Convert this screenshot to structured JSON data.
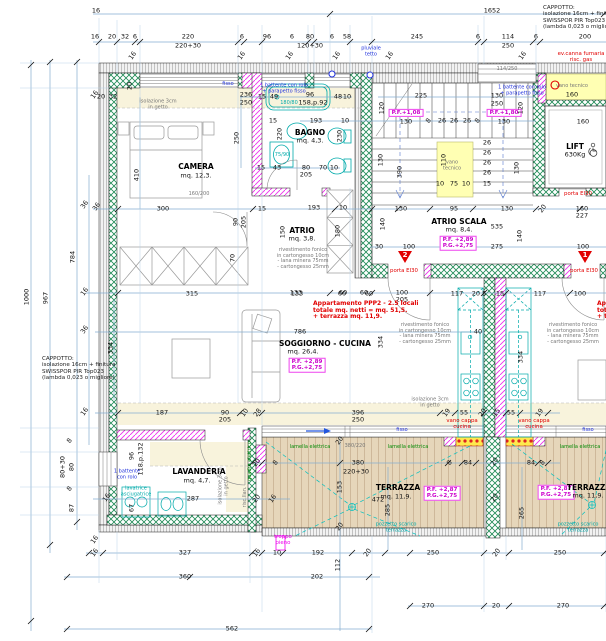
{
  "drawing": {
    "kind": "apartment floor plan",
    "apartment_note": "Appartamento PPP2 - 2.5 locali\ntotale mq. netti = mq. 51,5.\n+ terrazza mq. 11,9.",
    "cappotto_note": "CAPPOTTO:\nisolazione 16cm + finitura\nSWISSPOR PIR Top023\n(lambda 0,023 o migliore)",
    "rooms": [
      {
        "name": "CAMERA",
        "area": "mq. 12,3."
      },
      {
        "name": "BAGNO",
        "area": "mq. 4,3."
      },
      {
        "name": "ATRIO",
        "area": "mq. 3,8."
      },
      {
        "name": "ATRIO SCALA",
        "area": "mq. 8,4."
      },
      {
        "name": "SOGGIORNO - CUCINA",
        "area": "mq. 26,4."
      },
      {
        "name": "LAVANDERIA",
        "area": "mq. 4,7."
      },
      {
        "name": "TERRAZZA",
        "area": "mq. 11,9."
      },
      {
        "name": "LIFT",
        "load": "630Kg"
      }
    ],
    "levels": [
      "P.F.+1,08",
      "P.F.+1,80",
      "P.F. +2,89 / P.G.+2,75",
      "P.F. +2,87 / P.G.+2,75"
    ],
    "colors": {
      "structural_wall": "#1e8a55",
      "partition": "#ee30ee",
      "insulation_hatch": "#909090",
      "dim_line": "#85aed1",
      "fixture": "#00aaaa",
      "fire_label": "#e10000",
      "terrace_floor": "#e6d6ba",
      "vano_tecnico": "#ffffb3",
      "screed_band": "#f8f3dc"
    }
  },
  "labels": [
    [
      "1652",
      492,
      11,
      "d"
    ],
    [
      "16",
      96,
      11,
      "d"
    ],
    [
      "16",
      95,
      37,
      "d"
    ],
    [
      "20",
      112,
      37,
      "d"
    ],
    [
      "32",
      125,
      37,
      "d"
    ],
    [
      "6",
      135,
      37,
      "d"
    ],
    [
      "220",
      188,
      37,
      "d"
    ],
    [
      "6",
      242,
      37,
      "d"
    ],
    [
      "96",
      267,
      37,
      "d"
    ],
    [
      "6",
      292,
      37,
      "d"
    ],
    [
      "80",
      310,
      37,
      "d"
    ],
    [
      "6",
      332,
      37,
      "d"
    ],
    [
      "58",
      347,
      37,
      "d"
    ],
    [
      "245",
      417,
      37,
      "d"
    ],
    [
      "6",
      478,
      37,
      "d"
    ],
    [
      "114",
      508,
      37,
      "d"
    ],
    [
      "6",
      536,
      37,
      "d"
    ],
    [
      "200",
      585,
      37,
      "d"
    ],
    [
      "220+30",
      188,
      46,
      "d"
    ],
    [
      "120+30",
      310,
      46,
      "d"
    ],
    [
      "250",
      508,
      46,
      "d"
    ],
    [
      "pluviale\ntetto",
      371,
      52,
      "b"
    ],
    [
      "CAPPOTTO:\nisolazione 16cm + finitura\nSWISSPOR PIR Top023\n(lambda 0,023 o migliore)",
      543,
      5,
      "nl"
    ],
    [
      "ev.canna fumaria\nrisc. gas",
      581,
      57,
      "r"
    ],
    [
      "16",
      133,
      56,
      "d",
      -55
    ],
    [
      "16",
      242,
      56,
      "d",
      -55
    ],
    [
      "16",
      290,
      56,
      "d",
      -55
    ],
    [
      "16",
      337,
      56,
      "d",
      -55
    ],
    [
      "16",
      390,
      56,
      "d",
      -55
    ],
    [
      "16",
      523,
      56,
      "d",
      -55
    ],
    [
      "114/250",
      507,
      70,
      "s"
    ],
    [
      "1000",
      27,
      297,
      "d",
      -90
    ],
    [
      "967",
      46,
      298,
      "d",
      -90
    ],
    [
      "784",
      73,
      257,
      "d",
      -90
    ],
    [
      "36",
      85,
      205,
      "d",
      -55
    ],
    [
      "16",
      85,
      292,
      "d",
      -55
    ],
    [
      "36",
      85,
      330,
      "d",
      -55
    ],
    [
      "16",
      85,
      412,
      "d",
      -55
    ],
    [
      "CAPPOTTO:\nisolazione 16cm + finitura\nSWISSPOR PIR Top023\n(lambda 0,023 o migliore)",
      42,
      356,
      "nl"
    ],
    [
      "8",
      70,
      441,
      "d",
      -55
    ],
    [
      "80+30",
      63,
      467,
      "d",
      -90
    ],
    [
      "80",
      72,
      467,
      "d",
      -90
    ],
    [
      "8",
      70,
      489,
      "d",
      -55
    ],
    [
      "87",
      72,
      508,
      "d",
      -90
    ],
    [
      "16",
      95,
      95,
      "d",
      -55
    ],
    [
      "16",
      95,
      540,
      "d",
      -55
    ],
    [
      "fisso",
      228,
      85,
      "b"
    ],
    [
      "236",
      246,
      95,
      "d"
    ],
    [
      "250",
      246,
      103,
      "d"
    ],
    [
      "1 battente con rolo\n+ parapetto fisso",
      284,
      89,
      "b"
    ],
    [
      "isolazione 3cm\nin getto",
      158,
      105,
      "s"
    ],
    [
      "20",
      130,
      86,
      "d",
      -90
    ],
    [
      "32",
      113,
      97,
      "d"
    ],
    [
      "20",
      101,
      97,
      "d"
    ],
    [
      "CAMERA",
      196,
      167,
      "rm"
    ],
    [
      "mq. 12,3.",
      196,
      176,
      "d"
    ],
    [
      "160/200",
      199,
      195,
      "s"
    ],
    [
      "410",
      137,
      175,
      "d",
      -90
    ],
    [
      "250",
      237,
      138,
      "d",
      -90
    ],
    [
      "15",
      273,
      121,
      "d"
    ],
    [
      "300",
      163,
      209,
      "d"
    ],
    [
      "36",
      97,
      207,
      "d",
      -55
    ],
    [
      "15",
      262,
      209,
      "d"
    ],
    [
      "90",
      236,
      222,
      "d",
      -90
    ],
    [
      "205",
      244,
      222,
      "d",
      -90
    ],
    [
      "70",
      233,
      258,
      "d",
      -90
    ],
    [
      "15",
      262,
      97,
      "d"
    ],
    [
      "49",
      274,
      97,
      "d"
    ],
    [
      "96",
      310,
      95,
      "d"
    ],
    [
      "158,p.92",
      313,
      103,
      "d"
    ],
    [
      "48",
      338,
      97,
      "d"
    ],
    [
      "10",
      347,
      97,
      "d"
    ],
    [
      "180/80",
      289,
      104,
      "c"
    ],
    [
      "193",
      316,
      121,
      "d"
    ],
    [
      "10",
      345,
      121,
      "d"
    ],
    [
      "BAGNO",
      310,
      133,
      "rm"
    ],
    [
      "mq. 4,3.",
      310,
      141,
      "d"
    ],
    [
      "220",
      280,
      134,
      "d",
      -90
    ],
    [
      "230",
      340,
      136,
      "d",
      -90
    ],
    [
      "75/90",
      282,
      156,
      "c"
    ],
    [
      "15",
      261,
      168,
      "d"
    ],
    [
      "43",
      277,
      168,
      "d"
    ],
    [
      "80",
      306,
      168,
      "d"
    ],
    [
      "70",
      323,
      168,
      "d"
    ],
    [
      "10",
      334,
      168,
      "d"
    ],
    [
      "205",
      306,
      175,
      "d"
    ],
    [
      "ATRIO",
      302,
      231,
      "rm"
    ],
    [
      "mq. 3,8.",
      302,
      239,
      "d"
    ],
    [
      "rivestimento fonico\nin cartongesso 10cm\n- lana minera 75mm\n- cartongesso 25mm",
      303,
      259,
      "s"
    ],
    [
      "193",
      314,
      208,
      "d"
    ],
    [
      "10",
      343,
      208,
      "d"
    ],
    [
      "150",
      283,
      232,
      "d",
      -90
    ],
    [
      "180",
      338,
      231,
      "d",
      -90
    ],
    [
      "133",
      296,
      293,
      "d"
    ],
    [
      "60",
      343,
      293,
      "d"
    ],
    [
      "60",
      364,
      293,
      "d"
    ],
    [
      "100",
      402,
      293,
      "d"
    ],
    [
      "205",
      402,
      300,
      "d"
    ],
    [
      "225",
      421,
      96,
      "d"
    ],
    [
      "130",
      497,
      96,
      "d"
    ],
    [
      "250",
      497,
      104,
      "d"
    ],
    [
      "1 battente con rolo\n+ parapetto fisso",
      522,
      91,
      "b"
    ],
    [
      "P.F.+1,08",
      406,
      113,
      "pf"
    ],
    [
      "130",
      406,
      122,
      "d"
    ],
    [
      "P.F.+1,80",
      504,
      113,
      "pf"
    ],
    [
      "130",
      504,
      122,
      "d"
    ],
    [
      "8",
      429,
      121,
      "d",
      -55
    ],
    [
      "26",
      442,
      121,
      "d"
    ],
    [
      "26",
      454,
      121,
      "d"
    ],
    [
      "26",
      467,
      121,
      "d"
    ],
    [
      "8",
      478,
      121,
      "d",
      -55
    ],
    [
      "120",
      382,
      108,
      "d",
      -90
    ],
    [
      "120",
      521,
      108,
      "d",
      -90
    ],
    [
      "130",
      381,
      160,
      "d",
      -90
    ],
    [
      "390",
      400,
      172,
      "d",
      -90
    ],
    [
      "130",
      517,
      168,
      "d",
      -90
    ],
    [
      "26",
      487,
      143,
      "d"
    ],
    [
      "26",
      487,
      153,
      "d"
    ],
    [
      "26",
      487,
      163,
      "d"
    ],
    [
      "26",
      487,
      173,
      "d"
    ],
    [
      "15",
      487,
      184,
      "d"
    ],
    [
      "vano\ntecnico",
      452,
      166,
      "s"
    ],
    [
      "110",
      444,
      160,
      "d",
      -90
    ],
    [
      "75",
      454,
      184,
      "d"
    ],
    [
      "10",
      440,
      184,
      "d"
    ],
    [
      "10",
      466,
      184,
      "d"
    ],
    [
      "ATRIO SCALA",
      459,
      222,
      "rm"
    ],
    [
      "mq. 8,4.",
      459,
      230,
      "d"
    ],
    [
      "535",
      497,
      227,
      "d"
    ],
    [
      "P.F. +2,89\nP.G.+2,75",
      458,
      243,
      "pf"
    ],
    [
      "275",
      497,
      247,
      "d"
    ],
    [
      "140",
      383,
      224,
      "d",
      -90
    ],
    [
      "140",
      520,
      236,
      "d",
      -90
    ],
    [
      "130",
      401,
      209,
      "d"
    ],
    [
      "95",
      454,
      209,
      "d"
    ],
    [
      "130",
      507,
      209,
      "d"
    ],
    [
      "20",
      543,
      209,
      "d",
      -55
    ],
    [
      "160",
      582,
      209,
      "d"
    ],
    [
      "227",
      582,
      216,
      "d"
    ],
    [
      "30",
      379,
      247,
      "d"
    ],
    [
      "100",
      409,
      247,
      "d"
    ],
    [
      "100",
      583,
      247,
      "d"
    ],
    [
      "2",
      405,
      256,
      "tw"
    ],
    [
      "porta EI30",
      404,
      271,
      "r"
    ],
    [
      "1",
      585,
      256,
      "tw"
    ],
    [
      "porta EI30",
      584,
      271,
      "r"
    ],
    [
      "vano tecnico",
      572,
      87,
      "s"
    ],
    [
      "160",
      572,
      95,
      "d"
    ],
    [
      "160",
      583,
      122,
      "d"
    ],
    [
      "LIFT",
      575,
      147,
      "rm"
    ],
    [
      "630Kg",
      575,
      155,
      "d"
    ],
    [
      "porta EI30",
      578,
      194,
      "r"
    ],
    [
      "Appartamento PPP2 - 2.5 locali\ntotale mq. netti = mq. 51,5.\n+ terrazza mq. 11,9.",
      313,
      301,
      "ra"
    ],
    [
      "Apa\ntota\n+ te",
      597,
      301,
      "ra"
    ],
    [
      "786",
      300,
      332,
      "d"
    ],
    [
      "SOGGIORNO - CUCINA",
      325,
      344,
      "rm"
    ],
    [
      "mq. 26,4.",
      303,
      352,
      "d"
    ],
    [
      "P.F. +2,89\nP.G.+2,75",
      307,
      365,
      "pf"
    ],
    [
      "315",
      192,
      294,
      "d"
    ],
    [
      "133",
      297,
      294,
      "d"
    ],
    [
      "60",
      342,
      294,
      "d"
    ],
    [
      "60",
      369,
      294,
      "d"
    ],
    [
      "117",
      457,
      294,
      "d"
    ],
    [
      "20 5",
      479,
      294,
      "d"
    ],
    [
      "15",
      500,
      294,
      "d"
    ],
    [
      "117",
      540,
      294,
      "d"
    ],
    [
      "100",
      580,
      294,
      "d"
    ],
    [
      "334",
      111,
      348,
      "d",
      -90
    ],
    [
      "334",
      381,
      342,
      "d",
      -90
    ],
    [
      "334",
      521,
      357,
      "d",
      -90
    ],
    [
      "40",
      478,
      332,
      "d"
    ],
    [
      "rivestimento fonico\nin cartongesso 10cm\n- lana minera 75mm\n- cartongesso 25mm",
      425,
      334,
      "s"
    ],
    [
      "rivestimento fonico\nin cartongesso 10cm\n- lana minera 75mm\n- cartongesso 25mm",
      573,
      334,
      "s"
    ],
    [
      "isolazione 3cm\nin getto",
      430,
      403,
      "s"
    ],
    [
      "187",
      162,
      413,
      "d"
    ],
    [
      "90",
      225,
      413,
      "d"
    ],
    [
      "205",
      225,
      420,
      "d"
    ],
    [
      "10",
      245,
      413,
      "d",
      -55
    ],
    [
      "28",
      258,
      413,
      "d",
      -55
    ],
    [
      "396",
      358,
      413,
      "d"
    ],
    [
      "250",
      358,
      420,
      "d"
    ],
    [
      "19",
      447,
      413,
      "d",
      -55
    ],
    [
      "55",
      464,
      413,
      "d"
    ],
    [
      "20",
      483,
      413,
      "d",
      -55
    ],
    [
      "15",
      497,
      413,
      "d",
      -55
    ],
    [
      "55",
      511,
      413,
      "d"
    ],
    [
      "19",
      540,
      413,
      "d",
      -55
    ],
    [
      "vano cappa\ncucina",
      462,
      424,
      "r"
    ],
    [
      "vano cappa\ncucina",
      534,
      424,
      "r"
    ],
    [
      "fisso",
      402,
      431,
      "b"
    ],
    [
      "fisso",
      588,
      431,
      "b"
    ],
    [
      "380/220",
      355,
      447,
      "s"
    ],
    [
      "lamella elettrica",
      310,
      448,
      "g"
    ],
    [
      "lamella elettrica",
      408,
      448,
      "g"
    ],
    [
      "lamella elettrica",
      580,
      448,
      "g"
    ],
    [
      "96",
      132,
      456,
      "d",
      -90
    ],
    [
      "118,p.132",
      141,
      459,
      "d",
      -90
    ],
    [
      "1 battente\ncon rolo",
      127,
      475,
      "b"
    ],
    [
      "lavatrice\nasciugatrice",
      136,
      492,
      "c"
    ],
    [
      "67",
      132,
      508,
      "d",
      -90
    ],
    [
      "LAVANDERIA",
      199,
      472,
      "rm"
    ],
    [
      "mq. 4,7.",
      197,
      481,
      "d"
    ],
    [
      "287",
      193,
      499,
      "d"
    ],
    [
      "quadro elettrico",
      251,
      461,
      "g",
      -90
    ],
    [
      "risc.llan.",
      246,
      497,
      "s",
      -90
    ],
    [
      "isolazione 3cm\nin getto",
      224,
      486,
      "s",
      -90
    ],
    [
      "20",
      257,
      463,
      "d",
      -55
    ],
    [
      "8",
      276,
      463,
      "d",
      -55
    ],
    [
      "20",
      257,
      499,
      "d",
      -55
    ],
    [
      "16",
      273,
      499,
      "d",
      -55
    ],
    [
      "16",
      107,
      498,
      "d",
      -55
    ],
    [
      "troppo\npieno",
      283,
      540,
      "m"
    ],
    [
      "16",
      95,
      553,
      "d",
      -55
    ],
    [
      "327",
      185,
      553,
      "d"
    ],
    [
      "16",
      257,
      553,
      "d",
      -55
    ],
    [
      "10",
      277,
      553,
      "d"
    ],
    [
      "192",
      318,
      553,
      "d"
    ],
    [
      "20",
      368,
      553,
      "d",
      -55
    ],
    [
      "112",
      338,
      565,
      "d",
      -90
    ],
    [
      "360",
      185,
      577,
      "d"
    ],
    [
      "202",
      317,
      577,
      "d"
    ],
    [
      "562",
      232,
      629,
      "d"
    ],
    [
      "20",
      340,
      441,
      "d",
      -55
    ],
    [
      "153",
      340,
      487,
      "d",
      -90
    ],
    [
      "20",
      340,
      527,
      "d",
      -55
    ],
    [
      "380",
      358,
      463,
      "d"
    ],
    [
      "220+30",
      356,
      472,
      "d"
    ],
    [
      "8",
      450,
      463,
      "d",
      -55
    ],
    [
      "84",
      468,
      463,
      "d"
    ],
    [
      "84",
      531,
      463,
      "d"
    ],
    [
      "8",
      543,
      463,
      "d",
      -55
    ],
    [
      "20",
      495,
      462,
      "d",
      -55
    ],
    [
      "20",
      495,
      498,
      "d",
      -55
    ],
    [
      "472",
      378,
      500,
      "d"
    ],
    [
      "285",
      388,
      510,
      "d",
      -90
    ],
    [
      "265",
      522,
      513,
      "d",
      -90
    ],
    [
      "TERRAZZA",
      398,
      488,
      "rm"
    ],
    [
      "mq. 11,9.",
      396,
      497,
      "d"
    ],
    [
      "P.F. +2,87\nP.G.+2,75",
      442,
      493,
      "pf"
    ],
    [
      "P.F. +2,87\nP.G.+2,75",
      556,
      492,
      "pf"
    ],
    [
      "TERRAZZA",
      589,
      488,
      "rm"
    ],
    [
      "mq. 11,9.",
      588,
      496,
      "d"
    ],
    [
      "pozzetto scarico\nterrazza",
      396,
      528,
      "c"
    ],
    [
      "pozzetto scarico\nterrazza",
      578,
      528,
      "c"
    ],
    [
      "250",
      433,
      553,
      "d"
    ],
    [
      "20",
      497,
      553,
      "d",
      -55
    ],
    [
      "250",
      560,
      553,
      "d"
    ],
    [
      "270",
      428,
      606,
      "d"
    ],
    [
      "20",
      496,
      606,
      "d"
    ],
    [
      "270",
      563,
      606,
      "d"
    ]
  ]
}
